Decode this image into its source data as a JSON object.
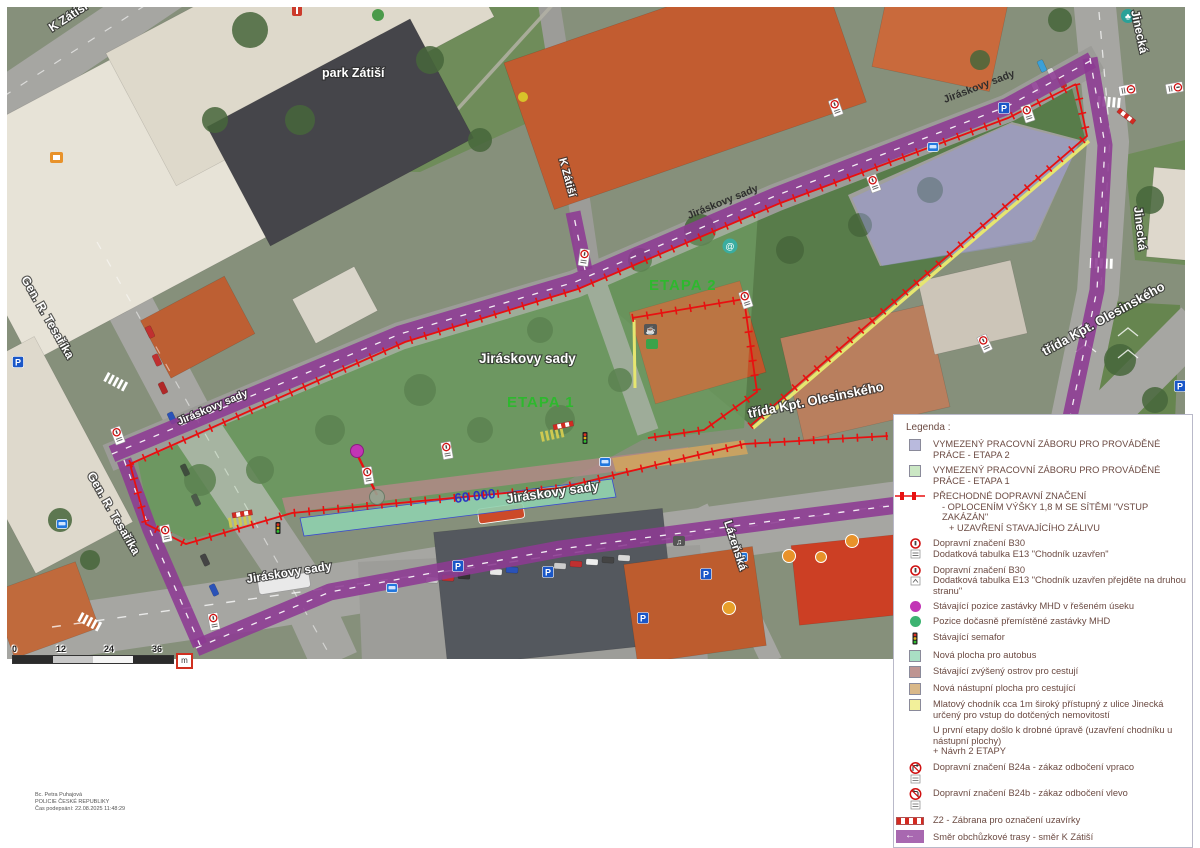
{
  "map": {
    "labels": {
      "k_zatisi_top": "K Zátiší",
      "k_zatisi_mid": "K Zátiší",
      "park_zatisi": "park Zátiší",
      "jiraskovy_sady_park": "Jiráskovy sady",
      "jiraskovy_band_w": "Jiráskovy sady",
      "jiraskovy_band_c": "Jiráskovy sady",
      "jiraskovy_band_e": "Jiráskovy sady",
      "jiraskovy_street_mid": "Jiráskovy sady",
      "jiraskovy_street_sw": "Jiráskovy sady",
      "trida_kpt_main": "třída Kpt. Olesinského",
      "trida_kpt_ne": "třída Kpt. Olesinského",
      "jinecka_top": "Jinecká",
      "jinecka_mid": "Jinecká",
      "lazenska": "Lázeňská",
      "gen_tesarika_top": "Gen. R. Tesaříka",
      "gen_tesarika_bottom": "Gen. R. Tesaříka",
      "etapa1": "ETAPA 1",
      "etapa2": "ETAPA 2",
      "dimension": "60 000"
    },
    "scalebar": {
      "t0": "0",
      "t1": "12",
      "t2": "24",
      "t3": "36",
      "unit": "m"
    }
  },
  "icons": {
    "parking_glyph": "P",
    "snail_glyph": "@",
    "tree_glyph": "♣",
    "coffee_glyph": "☕",
    "music_glyph": "♫"
  },
  "signature": {
    "line1": "Bc. Petra Puhajová",
    "line2": "POLICIE ČESKÉ REPUBLIKY",
    "line3": "Čas podepsání: 22.08.2025 11:48:29"
  },
  "legend": {
    "title": "Legenda :",
    "items": [
      {
        "symbol": "swatch-lavender",
        "lines": [
          "VYMEZENÝ PRACOVNÍ ZÁBORU PRO PROVÁDĚNÉ PRÁCE - ETAPA 2"
        ]
      },
      {
        "symbol": "swatch-green",
        "lines": [
          "VYMEZENÝ PRACOVNÍ ZÁBORU PRO PROVÁDĚNÉ PRÁCE - ETAPA 1"
        ]
      },
      {
        "symbol": "fence-line",
        "lines": [
          "PŘECHODNÉ DOPRAVNÍ ZNAČENÍ",
          "- OPLOCENÍM VÝŠKY 1,8 M SE SÍTĚMI \"VSTUP ZAKÁZÁN\"",
          "+ UZAVŘENÍ STAVAJÍCÍHO ZÁLIVU"
        ]
      },
      {
        "symbol": "sign-b30",
        "lines": [
          "Dopravní značení B30",
          "Dodatková tabulka E13 \"Chodník uzavřen\""
        ]
      },
      {
        "symbol": "sign-b30",
        "lines": [
          "Dopravní značení B30",
          "Dodatková tabulka E13 \"Chodník uzavřen přejděte na druhou stranu\""
        ]
      },
      {
        "symbol": "dot-magenta",
        "lines": [
          "Stávající pozice zastávky MHD v řešeném úseku"
        ]
      },
      {
        "symbol": "dot-green",
        "lines": [
          "Pozice dočasně přemístěné zastávky MHD"
        ]
      },
      {
        "symbol": "traffic-light",
        "lines": [
          "Stávající semafor"
        ]
      },
      {
        "symbol": "swatch-teal",
        "lines": [
          "Nová plocha pro autobus"
        ]
      },
      {
        "symbol": "swatch-mauve",
        "lines": [
          "Stávající zvýšený ostrov pro cestují"
        ]
      },
      {
        "symbol": "swatch-tan",
        "lines": [
          "Nová nástupní plocha pro cestující"
        ]
      },
      {
        "symbol": "swatch-yellow",
        "lines": [
          "Mlatový chodník cca 1m široký přístupný z ulice Jinecká určený pro vstup do dotčených nemovitostí"
        ]
      },
      {
        "symbol": "none",
        "lines": [
          "U první etapy došlo k drobné úpravě (uzavření chodníku u nástupní plochy)",
          "+ Návrh 2 ETAPY"
        ]
      },
      {
        "symbol": "sign-b24a",
        "lines": [
          "Dopravní značení B24a - zákaz odbočení vpraco"
        ]
      },
      {
        "symbol": "sign-b24b",
        "lines": [
          "Dopravní značení B24b - zákaz odbočení vlevo"
        ]
      },
      {
        "symbol": "z2-bar",
        "lines": [
          "Z2 - Zábrana pro označení uzavírky"
        ]
      },
      {
        "symbol": "detour-arrow",
        "lines": [
          "Směr obchůzkové trasy - směr  K Zátiší"
        ]
      },
      {
        "symbol": "sign-ip22",
        "lines": [
          "Dopravní značení IP22 - Chodci ve vozovce"
        ]
      }
    ]
  },
  "colors": {
    "detour_purple": "#8d3a93",
    "work_red": "#e81010",
    "etapa2_lavender": "#b9badd",
    "etapa1_green": "#cbe7c4",
    "bus_area_teal": "#8fd0ae",
    "island_mauve": "#b28887",
    "boarding_tan": "#cfa45f",
    "path_yellow": "#e6e670",
    "stop_magenta": "#c235b5",
    "stop_moved_green": "#3cb371"
  }
}
